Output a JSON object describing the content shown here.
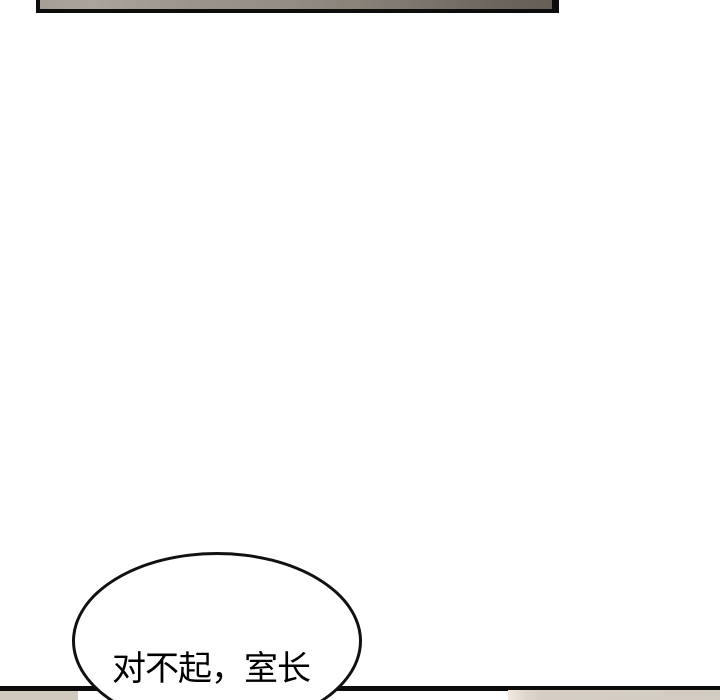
{
  "page": {
    "type": "webtoon-comic-page",
    "background_color": "#ffffff"
  },
  "panels": {
    "top_edge": {
      "description": "bottom-sliver-of-previous-panel",
      "border_color": "#0d0d0d",
      "fill_left": "#aba49c",
      "fill_mid": "#948d85",
      "fill_right": "#665f58"
    },
    "bottom_edge": {
      "description": "top-edge-of-next-panel",
      "divider_color": "#0d0d0d",
      "left_block_color": "#d0c9be",
      "right_block_color": "#d3ccc2",
      "right_block_highlight": "#f2eae2"
    }
  },
  "speech_bubble": {
    "text": "对不起，室长",
    "fill": "#ffffff",
    "outline_color": "#111111",
    "text_color": "#000000"
  }
}
